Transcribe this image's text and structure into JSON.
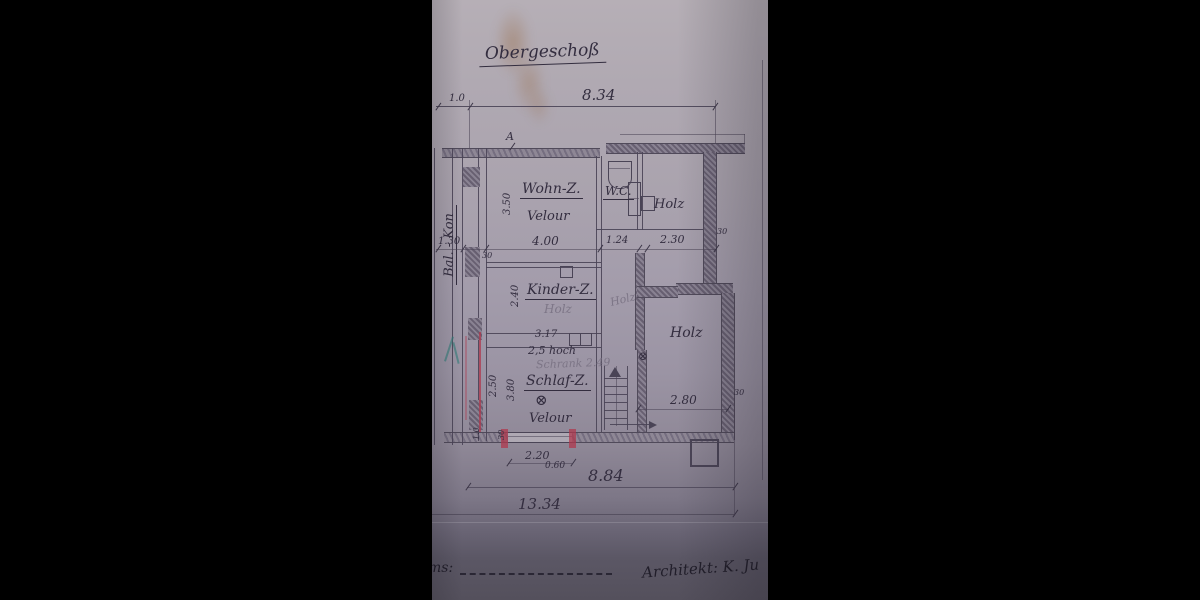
{
  "title": "Obergeschoß",
  "rooms": {
    "balcony": {
      "name": "Bal. - Kon"
    },
    "wohnzimmer": {
      "name": "Wohn-Z.",
      "floor": "Velour"
    },
    "wc": {
      "name": "W.C."
    },
    "holz_top": {
      "name": "Holz"
    },
    "kinderzimmer": {
      "name": "Kinder-Z.",
      "floor_pencil": "Holz"
    },
    "corridor": {
      "floor_pencil": "Holz"
    },
    "holz_right": {
      "name": "Holz"
    },
    "schlafzimmer": {
      "name": "Schlaf-Z.",
      "floor": "Velour"
    },
    "schrank": {
      "width": "3.17",
      "height_note": "2,5 hoch",
      "pencil_note": "Schrank 2.49"
    }
  },
  "dimensions": {
    "top_offset": "1.0",
    "top_span": "8.34",
    "balcony_width": "1.30",
    "wall_30": "30",
    "wohn_width": "4.00",
    "wohn_depth": "3.50",
    "wc_width": "1.24",
    "holz_top_width": "2.30",
    "kinder_depth": "2.40",
    "schlaf_d1": "2.50",
    "schlaf_d2": "3.80",
    "holz_right_width": "2.80",
    "bottom_small": "1.0",
    "window_width": "2.20",
    "window_height": "0.60",
    "span_inner": "8.84",
    "span_total": "13.34",
    "marker_a": "A"
  },
  "symbols": {
    "circle_x": "⊗"
  },
  "footer": {
    "left_label": "ms:",
    "right_label": "Architekt: K. Ju"
  }
}
